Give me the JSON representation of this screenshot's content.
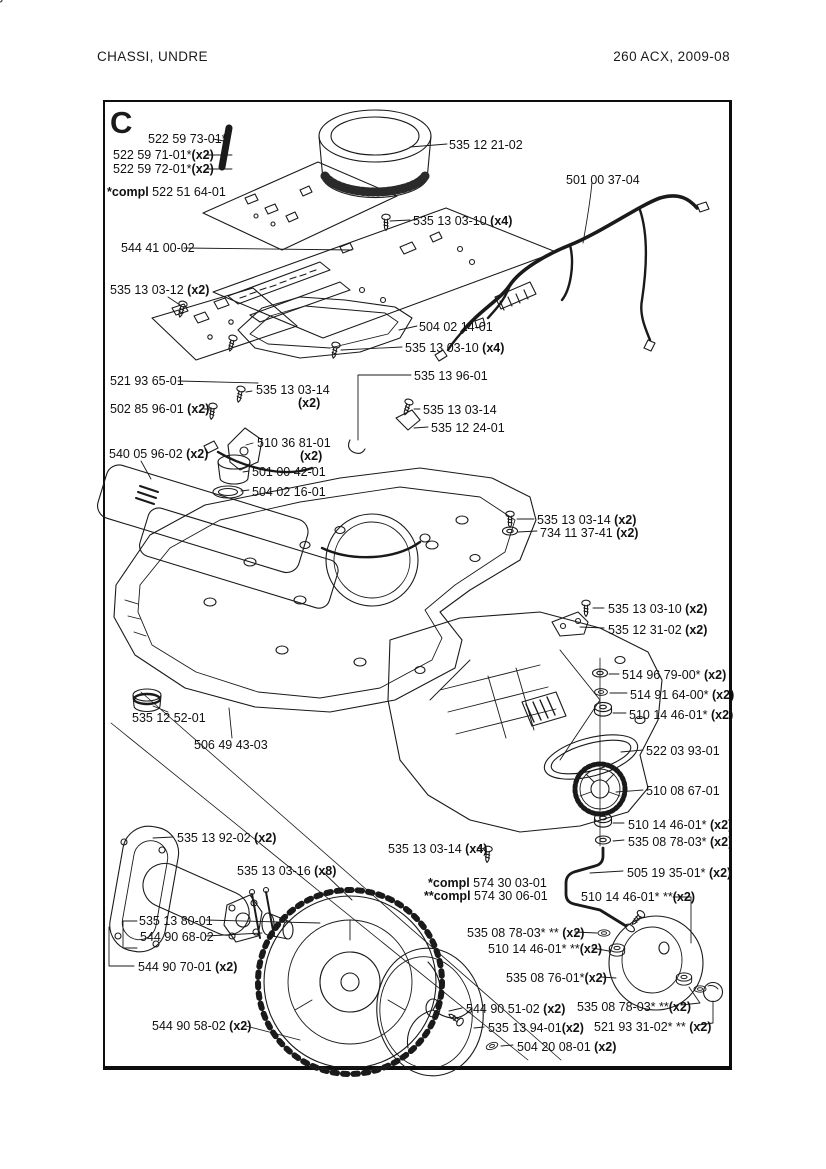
{
  "page": {
    "header_left": "CHASSI,  UNDRE",
    "header_right": "260 ACX, 2009-08",
    "section_letter": "C"
  },
  "labels": [
    {
      "text": "522 59 73-01*"
    },
    {
      "text": "522 59 71-01*",
      "qty": "(x2)"
    },
    {
      "text": "522 59 72-01*",
      "qty": "(x2)"
    },
    {
      "pre": "*compl",
      "text": " 522 51 64-01"
    },
    {
      "text": "544 41 00-02"
    },
    {
      "text": "535 12 21-02"
    },
    {
      "text": "501 00 37-04"
    },
    {
      "text": "535 13 03-10 ",
      "qty": "(x4)"
    },
    {
      "text": "535 13 03-12 ",
      "qty": "(x2)"
    },
    {
      "text": "504 02 14-01"
    },
    {
      "text": "535 13 03-10 ",
      "qty": "(x4)"
    },
    {
      "text": "521 93 65-01"
    },
    {
      "text": "535 13 03-14"
    },
    {
      "qty": "(x2)"
    },
    {
      "text": "502 85 96-01 ",
      "qty": "(x2)"
    },
    {
      "text": "535 13 96-01"
    },
    {
      "text": "535 13 03-14"
    },
    {
      "text": "535 12 24-01"
    },
    {
      "text": "510 36 81-01"
    },
    {
      "qty": "(x2)"
    },
    {
      "text": "540 05 96-02 ",
      "qty": "(x2)"
    },
    {
      "text": "501 00 42-01"
    },
    {
      "text": "504 02 16-01"
    },
    {
      "text": "535 13 03-14 ",
      "qty": "(x2)"
    },
    {
      "text": "734 11 37-41 ",
      "qty": "(x2)"
    },
    {
      "text": "535 13 03-10 ",
      "qty": "(x2)"
    },
    {
      "text": "535 12 31-02 ",
      "qty": "(x2)"
    },
    {
      "text": "514 96 79-00* ",
      "qty": "(x2)"
    },
    {
      "text": "514 91 64-00* ",
      "qty": "(x2)"
    },
    {
      "text": "510 14 46-01* ",
      "qty": "(x2)"
    },
    {
      "text": "535 12 52-01"
    },
    {
      "text": "522 03 93-01"
    },
    {
      "text": "506 49 43-03"
    },
    {
      "text": "510 08 67-01"
    },
    {
      "text": "510 14 46-01* ",
      "qty": "(x2)"
    },
    {
      "text": "535 08 78-03* ",
      "qty": "(x2)"
    },
    {
      "text": "535 13 92-02 ",
      "qty": "(x2)"
    },
    {
      "text": "535 13 03-14 ",
      "qty": "(x4)"
    },
    {
      "text": "505 19 35-01* ",
      "qty": "(x2)"
    },
    {
      "text": "535 13 03-16 ",
      "qty": "(x8)"
    },
    {
      "pre": "*compl",
      "text": " 574 30 03-01"
    },
    {
      "pre": "**compl",
      "text": " 574 30 06-01"
    },
    {
      "text": "510 14 46-01* **",
      "qty": "(x2)"
    },
    {
      "text": "535 13 80-01"
    },
    {
      "text": "544 90 68-02"
    },
    {
      "text": "535 08 78-03* ** ",
      "qty": "(x2)"
    },
    {
      "text": "510 14 46-01* **",
      "qty": "(x2)"
    },
    {
      "text": "544 90 70-01 ",
      "qty": "(x2)"
    },
    {
      "text": "535 08 76-01*",
      "qty": "(x2)"
    },
    {
      "text": "544 90 51-02 ",
      "qty": "(x2)"
    },
    {
      "text": "535 08 78-03* **",
      "qty": "(x2)"
    },
    {
      "text": "544 90 58-02 ",
      "qty": "(x2)"
    },
    {
      "text": "535 13 94-01",
      "qty": "(x2)"
    },
    {
      "text": "521 93 31-02* ** ",
      "qty": "(x2)"
    },
    {
      "text": "504 20 08-01 ",
      "qty": "(x2)"
    }
  ]
}
